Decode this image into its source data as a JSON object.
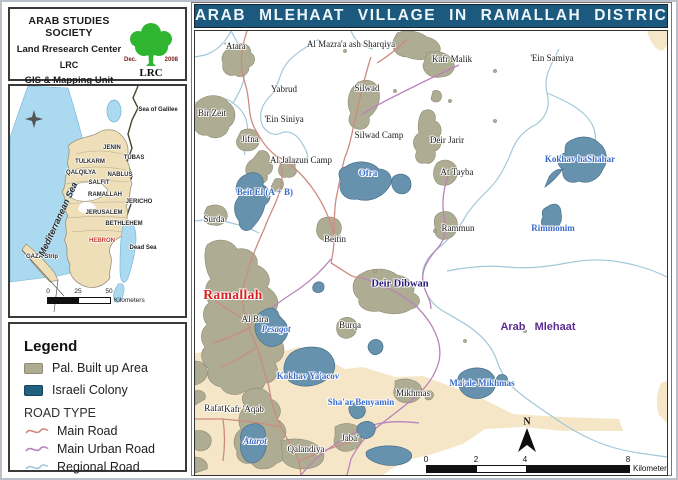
{
  "header": {
    "society": "ARAB STUDIES SOCIETY",
    "center": "Land Rresearch Center",
    "abbr": "LRC",
    "unit": "GIS & Mapping Unit",
    "logo": {
      "date_left": "Dec.",
      "date_right": "2008",
      "caption": "LRC"
    }
  },
  "inset": {
    "sea_label": "Mediterranean Sea",
    "compass_glyph": "✦",
    "labels": [
      {
        "text": "Sea of Galilee",
        "x": 148,
        "y": 24,
        "cls": "water"
      },
      {
        "text": "JENIN",
        "x": 102,
        "y": 62
      },
      {
        "text": "TUBAS",
        "x": 124,
        "y": 72
      },
      {
        "text": "TULKARM",
        "x": 80,
        "y": 76
      },
      {
        "text": "QALQILYA",
        "x": 71,
        "y": 87
      },
      {
        "text": "NABLUS",
        "x": 110,
        "y": 89
      },
      {
        "text": "SALFIT",
        "x": 89,
        "y": 97
      },
      {
        "text": "RAMALLAH",
        "x": 95,
        "y": 109
      },
      {
        "text": "JERICHO",
        "x": 129,
        "y": 116
      },
      {
        "text": "JERUSALEM",
        "x": 94,
        "y": 127
      },
      {
        "text": "BETHLEHEM",
        "x": 114,
        "y": 138
      },
      {
        "text": "HEBRON",
        "x": 92,
        "y": 155,
        "cls": "red"
      },
      {
        "text": "Dead Sea",
        "x": 133,
        "y": 162,
        "cls": "water"
      },
      {
        "text": "GAZA Strip",
        "x": 32,
        "y": 171
      }
    ],
    "scale": {
      "ticks": [
        "0",
        "25",
        "50"
      ],
      "unit": "Kilometers"
    }
  },
  "legend": {
    "title": "Legend",
    "area_items": [
      {
        "label": "Pal. Built up Area",
        "color": "#aeac93"
      },
      {
        "label": "Israeli Colony",
        "color": "#20617f"
      }
    ],
    "road_type_title": "ROAD TYPE",
    "road_items": [
      {
        "label": "Main Road",
        "color": "#cd8b80"
      },
      {
        "label": "Main Urban Road",
        "color": "#b983b9"
      },
      {
        "label": "Regional Road",
        "color": "#a3c8d9"
      }
    ]
  },
  "map": {
    "title": "ARAB MLEHAAT VILLAGE IN RAMALLAH DISTRICT",
    "places": [
      {
        "name": "'Atara",
        "x": 40,
        "y": 15
      },
      {
        "name": "Al Mazra'a ash Sharqiya",
        "x": 156,
        "y": 13
      },
      {
        "name": "Kafr Malik",
        "x": 257,
        "y": 28
      },
      {
        "name": "'Ein Samiya",
        "x": 357,
        "y": 27
      },
      {
        "name": "Yabrud",
        "x": 89,
        "y": 58
      },
      {
        "name": "Silwad",
        "x": 172,
        "y": 57
      },
      {
        "name": "Bir Zeit",
        "x": 17,
        "y": 82
      },
      {
        "name": "'Ein Siniya",
        "x": 89,
        "y": 88
      },
      {
        "name": "Jifna",
        "x": 55,
        "y": 108
      },
      {
        "name": "Silwad Camp",
        "x": 184,
        "y": 104
      },
      {
        "name": "Deir Jarir",
        "x": 252,
        "y": 109
      },
      {
        "name": "Al Jalazun Camp",
        "x": 106,
        "y": 129
      },
      {
        "name": "At Tayba",
        "x": 262,
        "y": 141
      },
      {
        "name": "Surda",
        "x": 19,
        "y": 188
      },
      {
        "name": "Rammun",
        "x": 263,
        "y": 197
      },
      {
        "name": "Beitin",
        "x": 140,
        "y": 208
      },
      {
        "name": "Al Bira",
        "x": 60,
        "y": 288
      },
      {
        "name": "Burqa",
        "x": 155,
        "y": 294
      },
      {
        "name": "Mikhmas",
        "x": 218,
        "y": 362
      },
      {
        "name": "Rafat",
        "x": 19,
        "y": 377
      },
      {
        "name": "Kafr 'Aqab",
        "x": 49,
        "y": 378
      },
      {
        "name": "Jaba'",
        "x": 155,
        "y": 407
      },
      {
        "name": "Qalandiya",
        "x": 111,
        "y": 418
      }
    ],
    "colonies": [
      {
        "name": "Beit El (A + B)",
        "x": 70,
        "y": 161
      },
      {
        "name": "Ofra",
        "x": 173,
        "y": 142
      },
      {
        "name": "Kokhav haShahar",
        "x": 385,
        "y": 128
      },
      {
        "name": "Rimmonim",
        "x": 358,
        "y": 197
      },
      {
        "name": "Pesagot",
        "x": 81,
        "y": 298,
        "cls": "italic"
      },
      {
        "name": "Kokhav Ya'acov",
        "x": 113,
        "y": 345
      },
      {
        "name": "Sha'ar Benyamin",
        "x": 166,
        "y": 371
      },
      {
        "name": "Ma'ale Mikhmas",
        "x": 287,
        "y": 352
      },
      {
        "name": "Atarot",
        "x": 60,
        "y": 410,
        "cls": "italic"
      }
    ],
    "special": [
      {
        "name": "Ramallah",
        "x": 38,
        "y": 264,
        "cls": "city-red"
      },
      {
        "name": "Deir Dibwan",
        "x": 205,
        "y": 253,
        "cls": "town-navy"
      },
      {
        "name": "Arab Mlehaat",
        "x": 343,
        "y": 296,
        "cls": "subject-purple"
      }
    ],
    "north_label": "N",
    "scalebar": {
      "ticks": [
        {
          "t": "0",
          "x": 231
        },
        {
          "t": "2",
          "x": 281
        },
        {
          "t": "4",
          "x": 330
        },
        {
          "t": "8",
          "x": 433
        }
      ],
      "unit": "Kilometers"
    }
  },
  "colors": {
    "title_bar_bg": "#1b5a7e",
    "builtup_fill": "#aeac93",
    "colony_fill": "#6792ad",
    "tan_zone": "#f6e6c8",
    "sea": "#abd9ef",
    "west_bank_fill": "#eedfb9",
    "main_road": "#cd8b80",
    "main_urban_road": "#b983b9",
    "regional_road": "#a3c8d9",
    "ramallah_label": "#d92020",
    "deir_dibwan_label": "#2b1b77",
    "arab_mlehaat_label": "#5c2d91",
    "colony_label": "#3a6bc9",
    "tree_green": "#2fb52f"
  }
}
